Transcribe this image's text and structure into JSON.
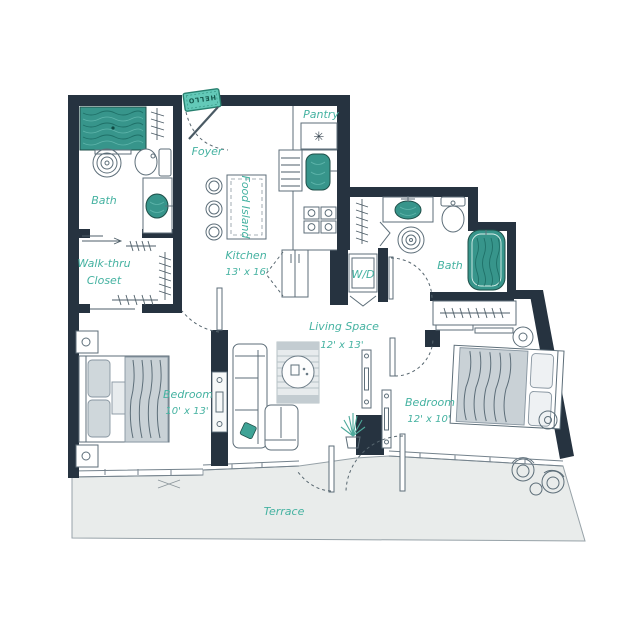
{
  "rooms": {
    "foyer": {
      "name": "Foyer"
    },
    "pantry": {
      "name": "Pantry",
      "symbol": "✳"
    },
    "kitchen": {
      "name": "Kitchen",
      "dims": "13' x 16'"
    },
    "food_island": {
      "name": "Food Island"
    },
    "bath_main": {
      "name": "Bath"
    },
    "walk_thru_closet": {
      "line1": "Walk-thru",
      "line2": "Closet"
    },
    "bedroom_main": {
      "name": "Bedroom",
      "dims": "10' x 13'"
    },
    "living": {
      "name": "Living Space",
      "dims": "12' x 13'"
    },
    "laundry": {
      "name": "W/D"
    },
    "bath_second": {
      "name": "Bath"
    },
    "bedroom_second": {
      "name": "Bedroom",
      "dims": "12' x 10'"
    },
    "terrace": {
      "name": "Terrace"
    }
  },
  "doormat": {
    "text": "HELLO"
  },
  "colors": {
    "wall": "#263340",
    "accent_teal": "#37958b",
    "label_teal": "#45b2a1",
    "doormat": "#63c9b8",
    "terrace_fill": "#e9eceb",
    "line": "#5d6e79"
  }
}
